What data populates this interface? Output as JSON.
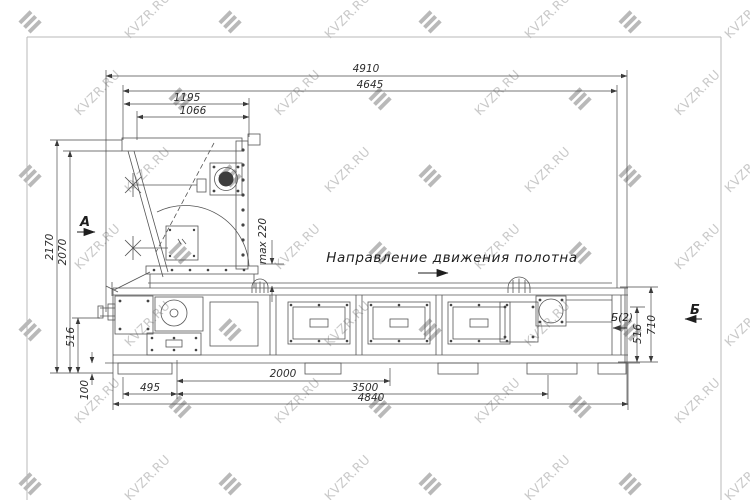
{
  "watermark": {
    "text": "KVZR.RU"
  },
  "labels": {
    "direction": "Направление движения полотна",
    "section_a": "А",
    "section_b": "Б",
    "section_b2": "Б(2)"
  },
  "dims": {
    "top": [
      "4910",
      "4645",
      "1195",
      "1066"
    ],
    "left": [
      "2170",
      "2070",
      "516",
      "100"
    ],
    "right": [
      "710",
      "516"
    ],
    "bottom": [
      "495",
      "2000",
      "3500",
      "4840"
    ],
    "max_height": "max 220"
  }
}
